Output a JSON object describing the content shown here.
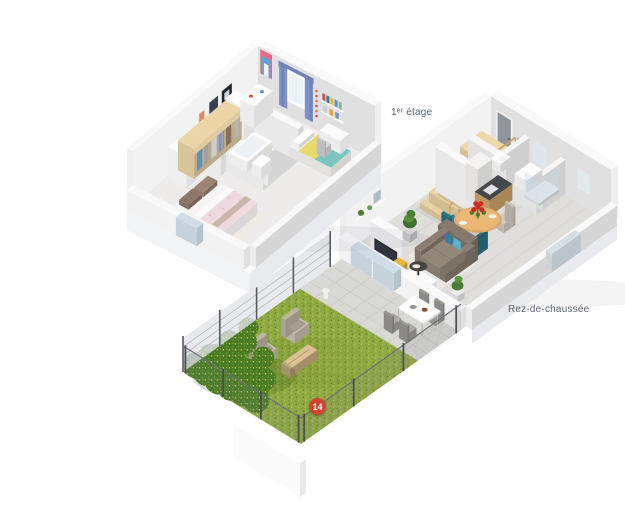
{
  "floors": {
    "first": {
      "label": "1ᵉʳ étage"
    },
    "ground": {
      "label": "Rez-de-chaussée"
    }
  },
  "marker": {
    "label": "14",
    "fill": "#d2452c",
    "text_color": "#ffffff"
  },
  "palette": {
    "wall_white": "#f9f9fa",
    "floor_light": "#edecea",
    "floor_tile": "#dfdedb",
    "wood_light": "#ecd6a8",
    "stair_wood": "#e9d2a2",
    "lawn": "#8fa943",
    "lawn_dark": "#7d962f",
    "hedge": "#4a7a24",
    "hedge_light": "#b9d257",
    "terrace": "#d8d8d5",
    "sofa": "#8c7e72",
    "cushion_blue": "#2e7ea8",
    "bed_pink": "#f0d9de",
    "bed_child_yellow": "#e9d96d",
    "bed_child_teal": "#79c7c0",
    "curtain_blue": "#7d92c6",
    "table_wood": "#d9a96b",
    "chair_teal": "#2e7f92",
    "flower_red": "#cc2b28",
    "label_text": "#5c646e"
  }
}
